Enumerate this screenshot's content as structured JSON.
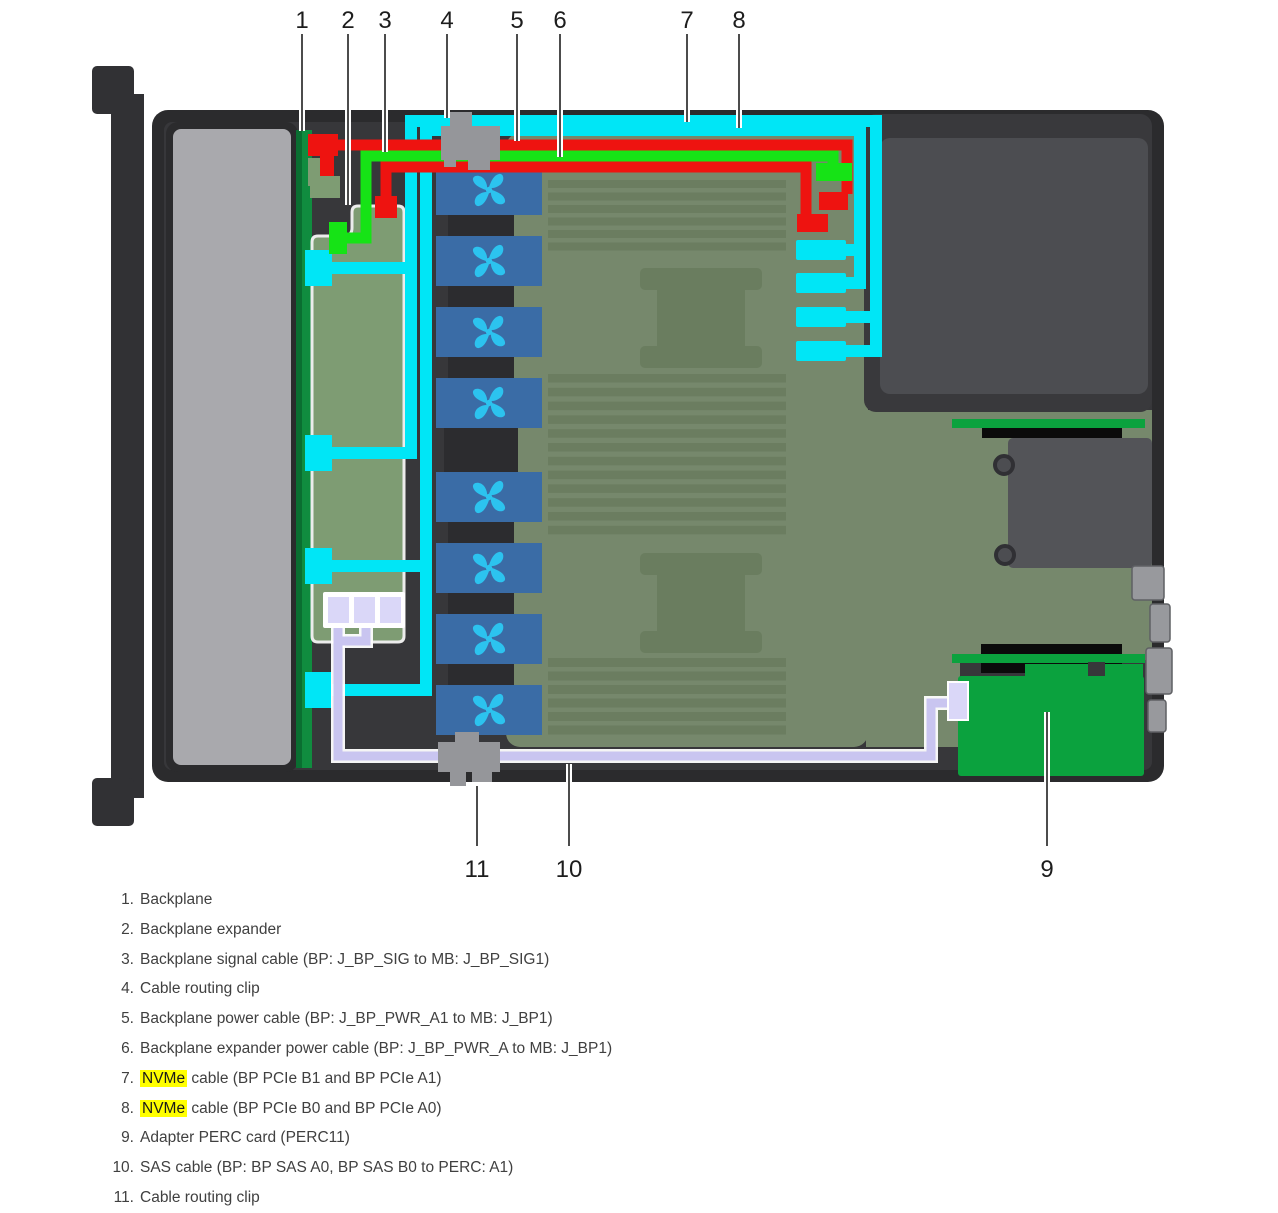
{
  "figure": {
    "description": "Server chassis top view showing backplane, expander, fans, motherboard, PSU bay and cable routing for signal, power, NVMe and SAS cables",
    "callouts_top": [
      "1",
      "2",
      "3",
      "4",
      "5",
      "6",
      "7",
      "8"
    ],
    "callouts_bottom": [
      "11",
      "10",
      "9"
    ]
  },
  "legend": {
    "items": [
      {
        "n": "1.",
        "hl": "",
        "t": "Backplane"
      },
      {
        "n": "2.",
        "hl": "",
        "t": "Backplane expander"
      },
      {
        "n": "3.",
        "hl": "",
        "t": "Backplane signal cable (BP: J_BP_SIG to MB: J_BP_SIG1)"
      },
      {
        "n": "4.",
        "hl": "",
        "t": "Cable routing clip"
      },
      {
        "n": "5.",
        "hl": "",
        "t": "Backplane power cable (BP: J_BP_PWR_A1 to MB: J_BP1)"
      },
      {
        "n": "6.",
        "hl": "",
        "t": "Backplane expander power cable (BP: J_BP_PWR_A to MB: J_BP1)"
      },
      {
        "n": "7.",
        "hl": "NVMe",
        "t": " cable (BP PCIe B1 and BP PCIe A1)"
      },
      {
        "n": "8.",
        "hl": "NVMe",
        "t": " cable (BP PCIe B0 and BP PCIe A0)"
      },
      {
        "n": "9.",
        "hl": "",
        "t": "Adapter PERC card (PERC11)"
      },
      {
        "n": "10.",
        "hl": "",
        "t": "SAS cable (BP: BP SAS A0, BP SAS B0 to PERC: A1)"
      },
      {
        "n": "11.",
        "hl": "",
        "t": "Cable routing clip"
      }
    ]
  },
  "colors": {
    "cyan": "#00e6f6",
    "red": "#ee1310",
    "green": "#16e316",
    "sas": "#c9c5f0",
    "sasconn": "#dad7f8",
    "highlight": "#ffff00",
    "clip": "#95969a",
    "fan": "#3a6ca6",
    "fanblade": "#2cc3ef",
    "mobo": "#76886c",
    "expander": "#7e9c73",
    "backplane": "#108c3f",
    "perc": "#0ba23e",
    "interior": "#37373a",
    "wall": "#2b2b2d",
    "bay": "#a9a9ad",
    "psu": "#4c4d51",
    "text": "#404040"
  }
}
